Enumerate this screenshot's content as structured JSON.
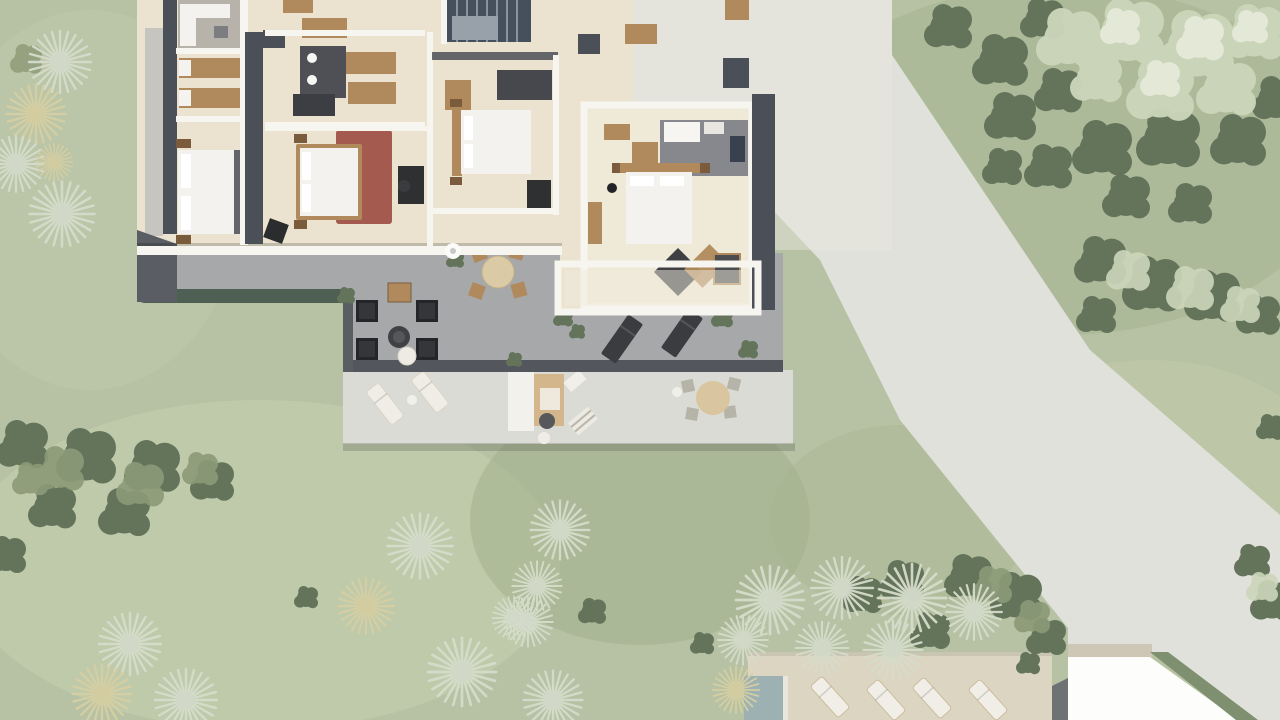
{
  "scene": {
    "type": "architectural-3d-aerial-site-plan",
    "description": "Top-down 3D render of a villa upper floor plan with four bedrooms, bathroom and staircase, a roof terrace with black lounge armchairs, round dining table and sun loungers, a lower terrace with outdoor kitchen and dining parasol set, a pool sun deck with white loungers, a neighboring white flat roof, lawns with palm rosettes and tree clusters, and a curved light-grey access road",
    "elements": [
      {
        "name": "lawn",
        "kind": "grass"
      },
      {
        "name": "access-road",
        "kind": "paving"
      },
      {
        "name": "driveway-apron",
        "kind": "paving"
      },
      {
        "name": "villa-building",
        "kind": "building",
        "rooms": [
          "lounge-nook",
          "dressing-room",
          "master-bedroom",
          "bathroom",
          "bedroom-2",
          "bedroom-3",
          "bedroom-4",
          "hallway",
          "staircase"
        ]
      },
      {
        "name": "roof-terrace",
        "kind": "terrace",
        "furniture": [
          "black-lounge-armchairs",
          "round-coffee-table",
          "white-side-table",
          "wood-stool",
          "outdoor-dining-set",
          "dark-sun-loungers",
          "planter-shrubs",
          "hedge"
        ]
      },
      {
        "name": "lower-terrace",
        "kind": "terrace",
        "furniture": [
          "white-sun-loungers",
          "outdoor-kitchen",
          "striped-benches",
          "parasol-dining-set"
        ]
      },
      {
        "name": "sun-deck",
        "kind": "deck",
        "furniture": [
          "white-sun-loungers"
        ],
        "adjacent": "pool-edge"
      },
      {
        "name": "neighbor-roof",
        "kind": "building"
      },
      {
        "name": "tree-clusters",
        "kind": "vegetation"
      },
      {
        "name": "palm-clusters",
        "kind": "vegetation"
      }
    ]
  },
  "colors": {
    "grass": "#b7c2a4",
    "grass-light": "#c8d1b2",
    "grass-dark": "#a2b18c",
    "road": "#e0e1da",
    "road-light": "#e8e8e1",
    "tree-dark": "#64745a",
    "tree-mid": "#8b9a77",
    "tree-light": "#ccd6ba",
    "tree-pale": "#e6ebdb",
    "palm-light": "#d6dccb",
    "palm-yellow": "#d6cfa2",
    "palm-core": "#6e7860",
    "floor": "#ebe3d0",
    "floor-light": "#f2ecdd",
    "wall-white": "#f7f5ef",
    "wall-dark": "#4b4f57",
    "gravel": "#c7c5c0",
    "terrace": "#a7a8aa",
    "terrace-edge": "#53565c",
    "hedge": "#4e5f53",
    "platform": "#dadbd4",
    "deck": "#dcd5c2",
    "pool": "#9db1b2",
    "rug": "#a55a4f",
    "wood": "#b08a5c",
    "wood-dark": "#7a5c3c",
    "bed-white": "#f3f2ee",
    "furn-black": "#26272a",
    "slate": "#46505c",
    "roof-white": "#fdfdfb",
    "roof-tan": "#cfc7b5",
    "strip-green": "#7e9070"
  }
}
